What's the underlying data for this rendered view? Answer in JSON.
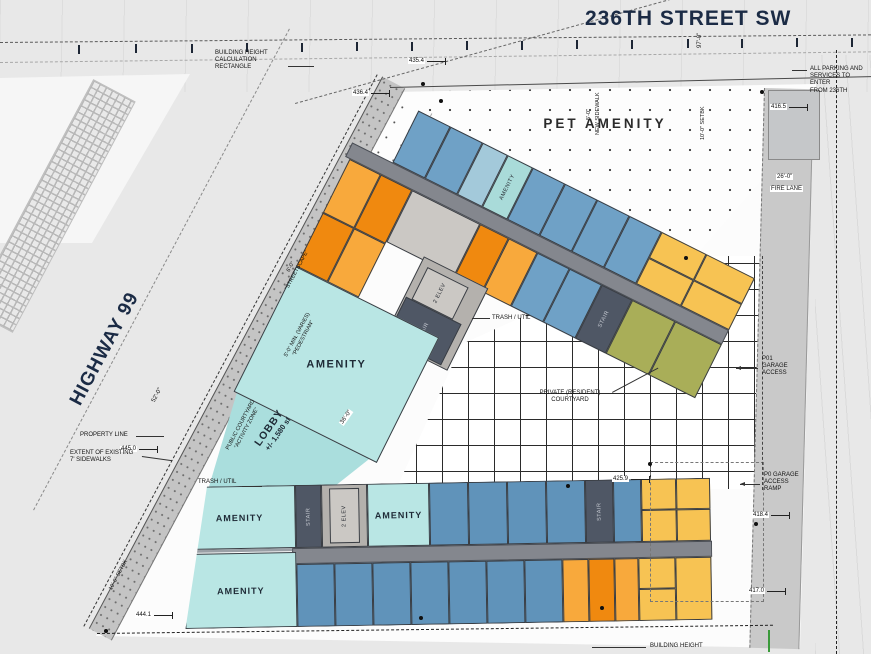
{
  "title": {
    "street_top": "236TH STREET SW",
    "street_left": "HIGHWAY 99"
  },
  "areas": {
    "pet_amenity": "PET AMENITY",
    "amenity": "AMENITY",
    "lobby": "LOBBY",
    "lobby_area": "+/- 1,580 sf",
    "private_courtyard": "PRIVATE (RESIDENT)\nCOURTYARD",
    "stair": "STAIR",
    "elev": "2 ELEV",
    "trash_util": "TRASH / UTIL"
  },
  "notes": {
    "building_height_calc": "BUILDING HEIGHT\nCALCULATION\nRECTANGLE",
    "all_parking": "ALL PARKING AND\nSERVICES TO ENTER\nFROM 236TH",
    "property_line": "PROPERTY LINE",
    "extent_sidewalks": "EXTENT OF EXISTING\n7' SIDEWALKS",
    "p01_garage": "P01\nGARAGE\nACCESS",
    "p0_ramp": "P0 GARAGE\nACCESS\nRAMP",
    "fire_lane": "FIRE LANE",
    "building_height": "BUILDING HEIGHT",
    "new_sidewalk": "NEW SIDEWALK",
    "new_sidewalk_dim": "5'-0\"",
    "setback": "10'-0\" SETBK",
    "streetscape": "6'-0\"\n\"STREETSCAPE\"",
    "pedestrian": "5'-0\" MIN. (VARIES)\n\"PEDESTRIAN\"",
    "public_courtyard": "PUBLIC COURTYARD\n\"ACTIVITY ZONE\""
  },
  "dims": {
    "e435_4": "435.4",
    "e436_4": "436.4",
    "e416_5": "416.5",
    "e445_0": "445.0",
    "e444_1": "444.1",
    "e425_9": "425.9",
    "e418_4": "418.4",
    "e417_0": "417.0",
    "w26": "26'-0\"",
    "w97": "97'-0\"",
    "w52": "52'-0\"",
    "w36": "36'-0\""
  },
  "colors": {
    "unit_blue": "#6fa1c6",
    "unit_blue_dark": "#6093ba",
    "unit_light_blue": "#a3c9da",
    "amenity_teal": "#a9dbd9",
    "amenity_teal_light": "#b9e6e4",
    "unit_orange": "#f8a93c",
    "unit_orange_dark": "#f0890f",
    "unit_yellow": "#f7c353",
    "unit_olive": "#a9ae58",
    "corridor_gray": "#84878e",
    "core_gray": "#b4b1ad",
    "stair_slate": "#4f5765",
    "title_navy": "#1b2b45",
    "fire_lane_gray": "#c9c9c9"
  }
}
